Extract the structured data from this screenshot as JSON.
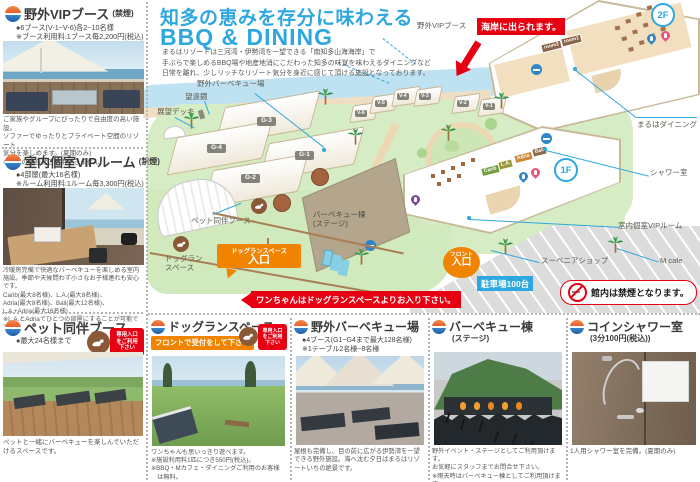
{
  "header": {
    "title1": "知多の恵みを存分に味わえる",
    "title2": "BBQ & DINING",
    "intro": "まるはリゾートは三河湾・伊勢湾を一望できる「南知多山海海岸」で\n手ぶらで楽しめるBBQ場や地産地消にこだわった知多の味覚を味わえるダイニングなど\n日常を離れ、少しリッチなリゾート気分を身近に感じて頂ける施設となっております。"
  },
  "sections": {
    "vip_booth": {
      "title": "野外VIPブース",
      "note": "(禁煙)",
      "b1": "●6ブース(V-1~V-6)各2~10名様",
      "b2": "※ブース利用料:1ブース毎2,200円(税込)",
      "caption": "ご家族やグループにぴったりで自由度の高い施設。\nソファーでゆったりとプライベート空間のリゾート\n気分を楽しめます。(夏期のみ)\n※雨天の場合はご利用できません。"
    },
    "vip_room": {
      "title": "室内個室VIPルーム",
      "note": "(禁煙)",
      "b1": "●4部屋(最大16名様)",
      "b2": "※ルーム利用料:1ルーム毎3,300円(税込)",
      "caption": "冷暖房完備で快適なバーベキューを楽しめる室内施設。季節や天候問わず小さなお子様連れも安心です。\nCarib(最大8名様)、L.A.(最大8名様)、\nAdria(最大8名様)、Bali(最大12名様)、\nL.A.+Adria(最大16名様)\n※L.A.とAdriaでひとつの部屋にすることが可能です。"
    },
    "pet_booth": {
      "title": "ペット同伴ブース",
      "b1": "●最大24名様まで",
      "badge": "専用入口\nをご利用\n下さい",
      "caption": "ペットと一緒にバーベキューを楽しんでいただけるスペースです。"
    },
    "dog_run": {
      "title": "ドッグランスペース",
      "reception": "フロントで受付をして下さい",
      "badge": "専用入口\nをご利用\n下さい",
      "caption": "ワンちゃんも思いっきり遊べます。\n※施設利用料1匹につき550円(税込)。\n※BBQ・Mカフェ・ダイニングご利用のお客様\n　は無料。"
    },
    "bbq_field": {
      "title": "野外バーベキュー場",
      "b1": "●4ブース(G1~G4まで最大128名様)",
      "b2": "※1テーブル2名様~8名様",
      "caption": "屋根も完備し、目の前に広がる伊勢湾を一望できる野外施設。海へ沈む夕日はまるはリゾートいちの絶景です。"
    },
    "bbq_hall": {
      "title": "バーベキュー棟",
      "note": "(ステージ)",
      "caption": "野外イベント・ステージとしてご利用頂けます。\nお気軽にスタッフまでお問合せ下さい。\n※雨天時はバーベキュー棟としてご利用頂けます。"
    },
    "shower": {
      "title": "コインシャワー室",
      "note": "(3分100円(税込))",
      "caption": "1人用シャワー室を完備。(夏期のみ)"
    }
  },
  "map": {
    "labels": {
      "outdoor_vip": "野外VIPブース",
      "bbq_field": "野外バーベキュー場",
      "telescope": "望遠鏡",
      "deck": "展望デッキ",
      "pet_booth": "ペット同伴ブース",
      "dog_run": "ドッグラン\nスペース",
      "bbq_hall": "バーベキュー棟\n(ステージ)",
      "dining": "まるはダイニング",
      "shower": "シャワー室",
      "vip_room": "室内個室VIPルーム",
      "mcafe": "M cafe",
      "souvenir": "スーベニアショップ"
    },
    "beach_note": "海岸に出られます。",
    "dog_notice": "ワンちゃんはドッグランスペースよりお入り下さい。",
    "no_smoking": "館内は禁煙となります。",
    "dog_entrance": {
      "line1": "ドッグランスペース",
      "line2": "入口"
    },
    "front": {
      "line1": "フロント",
      "line2": "入口"
    },
    "parking": "駐車場100台",
    "floor1": "1F",
    "floor2": "2F",
    "rooms": [
      "Carib",
      "L.A.",
      "Adria",
      "Bali"
    ],
    "dining_rooms": [
      "room2",
      "room1"
    ],
    "g_booths": [
      "G-1",
      "G-2",
      "G-3",
      "G-4"
    ],
    "v_booths": [
      "V-1",
      "V-2",
      "V-3",
      "V-4",
      "V-5",
      "V-6"
    ]
  },
  "colors": {
    "accent_blue": "#2ea7e0",
    "red": "#e60012",
    "orange": "#f08300"
  }
}
